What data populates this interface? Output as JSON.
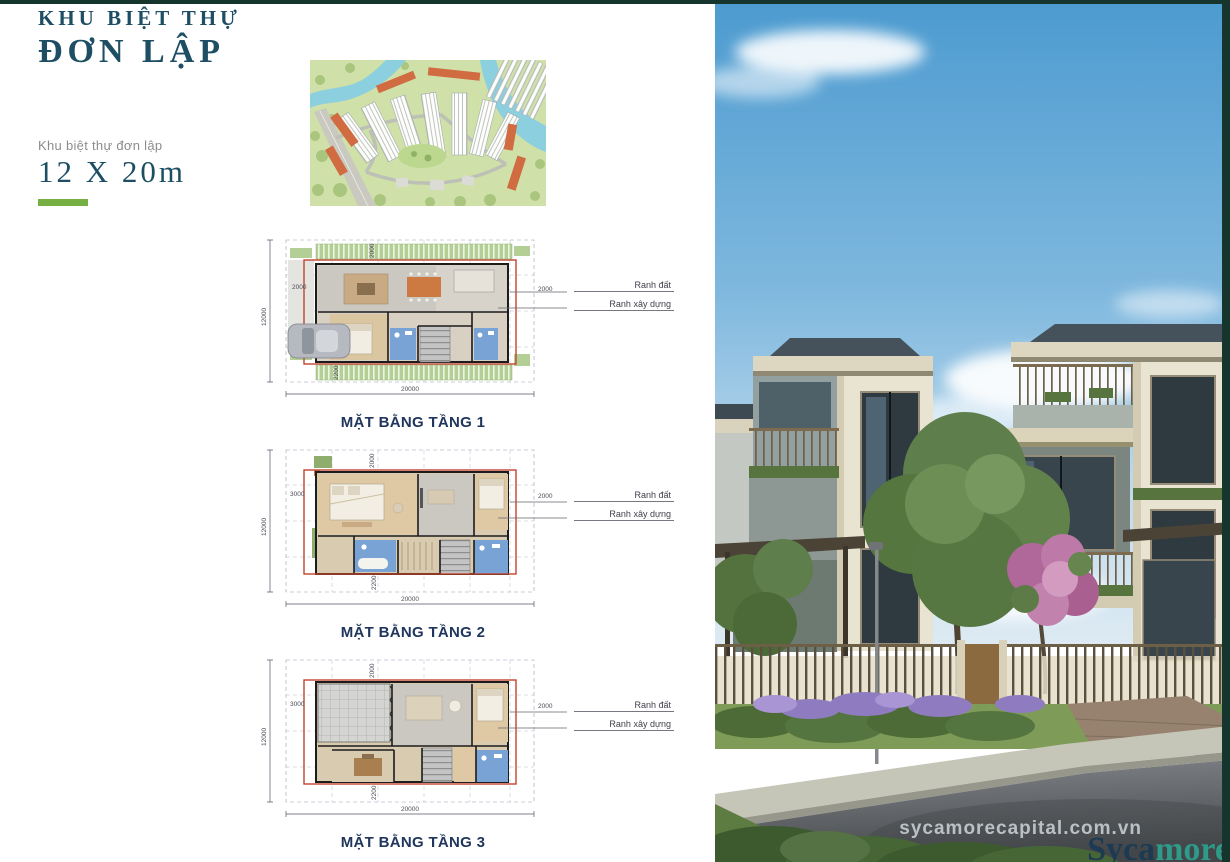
{
  "header": {
    "title_line1": "KHU BIỆT THỰ",
    "title_line2": "ĐƠN LẬP"
  },
  "spec": {
    "label": "Khu biệt thự đơn lập",
    "size": "12 X 20m"
  },
  "legend": {
    "land": "Ranh đất",
    "build": "Ranh xây dựng"
  },
  "plans": [
    {
      "caption": "MẶT BẰNG TẦNG 1",
      "dims": {
        "top": "2000",
        "left": "2000",
        "side": "12000",
        "right": "2000",
        "bottom_inner": "2200",
        "bottom": "20000"
      }
    },
    {
      "caption": "MẶT BẰNG TẦNG 2",
      "dims": {
        "top": "2000",
        "left": "3000",
        "side": "12000",
        "right": "2000",
        "bottom_inner": "2200",
        "bottom": "20000"
      }
    },
    {
      "caption": "MẶT BẰNG TẦNG 3",
      "dims": {
        "top": "2000",
        "left": "3000",
        "side": "12000",
        "right": "2000",
        "bottom_inner": "2200",
        "bottom": "20000"
      }
    }
  ],
  "watermark": {
    "site": "sycamorecapital.com.vn",
    "brand_dark": "Syca",
    "brand_light": "more"
  },
  "colors": {
    "accent_green": "#76b043",
    "title_navy": "#1d4e63",
    "border_teal": "#16352d",
    "plan_boundary_red": "#c0452f",
    "brand_teal": "#2e9a89"
  }
}
